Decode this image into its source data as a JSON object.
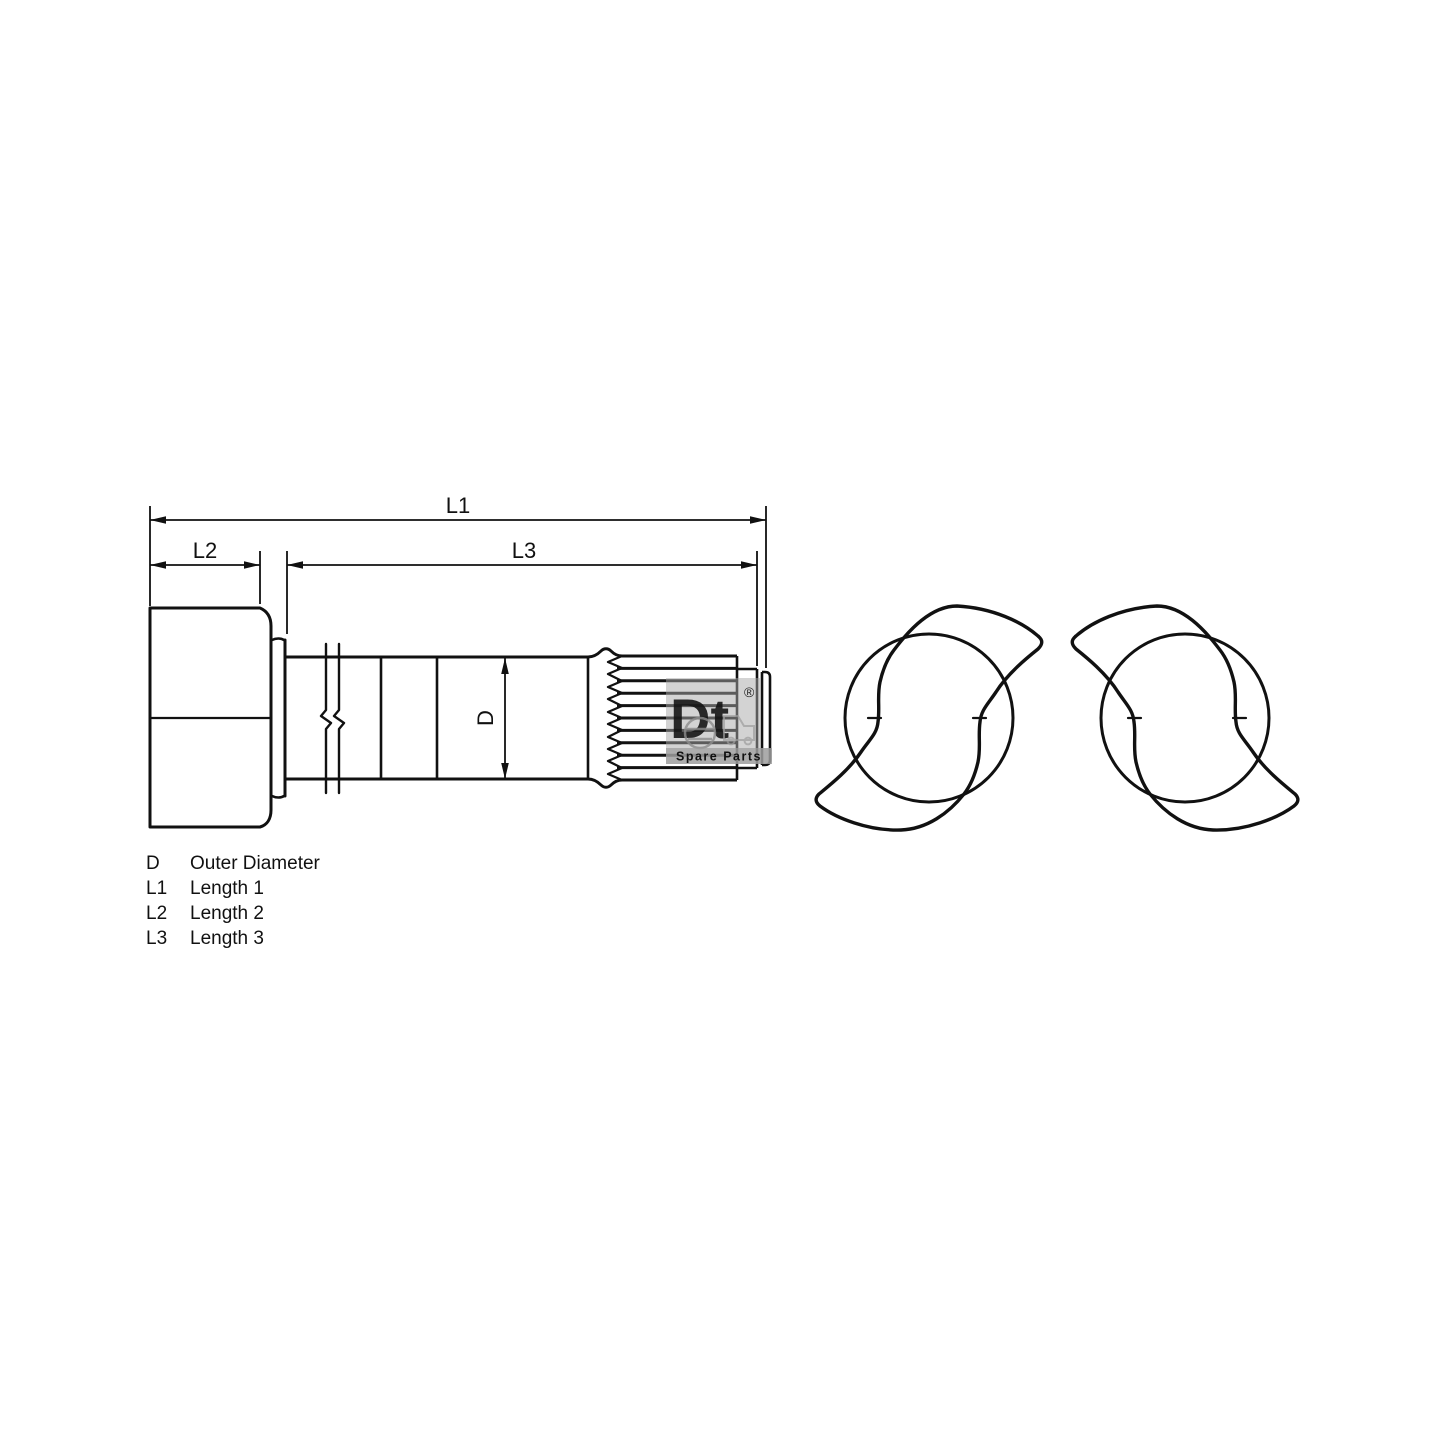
{
  "drawing": {
    "description": "Brake camshaft technical line drawing with dimension callouts and two S-cam profile views",
    "dimension_labels": {
      "l1": "L1",
      "l2": "L2",
      "l3": "L3",
      "d": "D"
    },
    "legend": {
      "rows": [
        {
          "symbol": "D",
          "description": "Outer Diameter"
        },
        {
          "symbol": "L1",
          "description": "Length 1"
        },
        {
          "symbol": "L2",
          "description": "Length 2"
        },
        {
          "symbol": "L3",
          "description": "Length 3"
        }
      ]
    },
    "watermark": {
      "brand": "Dt",
      "registered": "®",
      "tagline": "Spare Parts"
    },
    "colors": {
      "line": "#111111",
      "background": "#ffffff",
      "watermark_gray": "#9d9d9d"
    }
  }
}
